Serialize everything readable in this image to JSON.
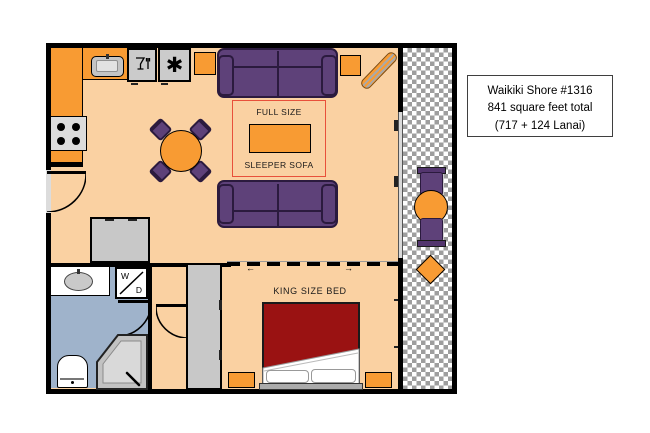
{
  "info_box": {
    "lines": [
      "Waikiki Shore #1316",
      "841 square feet total",
      "(717 + 124 Lanai)"
    ]
  },
  "living_room": {
    "sofa_label_line1": "FULL SIZE",
    "sofa_label_line2": "SLEEPER SOFA"
  },
  "bedroom": {
    "bed_label": "KING SIZE BED",
    "partition_arrow_left": "←",
    "partition_arrow_right": "→"
  },
  "bathroom": {
    "washer_dryer_top": "W",
    "washer_dryer_bottom": "D"
  },
  "icons": {
    "freezer_glyph": "✱",
    "dishwasher": "wine-glass-and-fork",
    "sink": "kitchen-sink",
    "stove": "four-burner-stove"
  },
  "colors": {
    "floor": "#FAD1A2",
    "furniture_orange": "#F89B33",
    "sofa_purple": "#5E4179",
    "bed_red": "#9A1212",
    "bathroom_blue": "#9FB3CB",
    "wall_black": "#000000",
    "sleeper_outline_red": "#E8503A",
    "lanai_checker_gray": "#9E9E9E"
  }
}
